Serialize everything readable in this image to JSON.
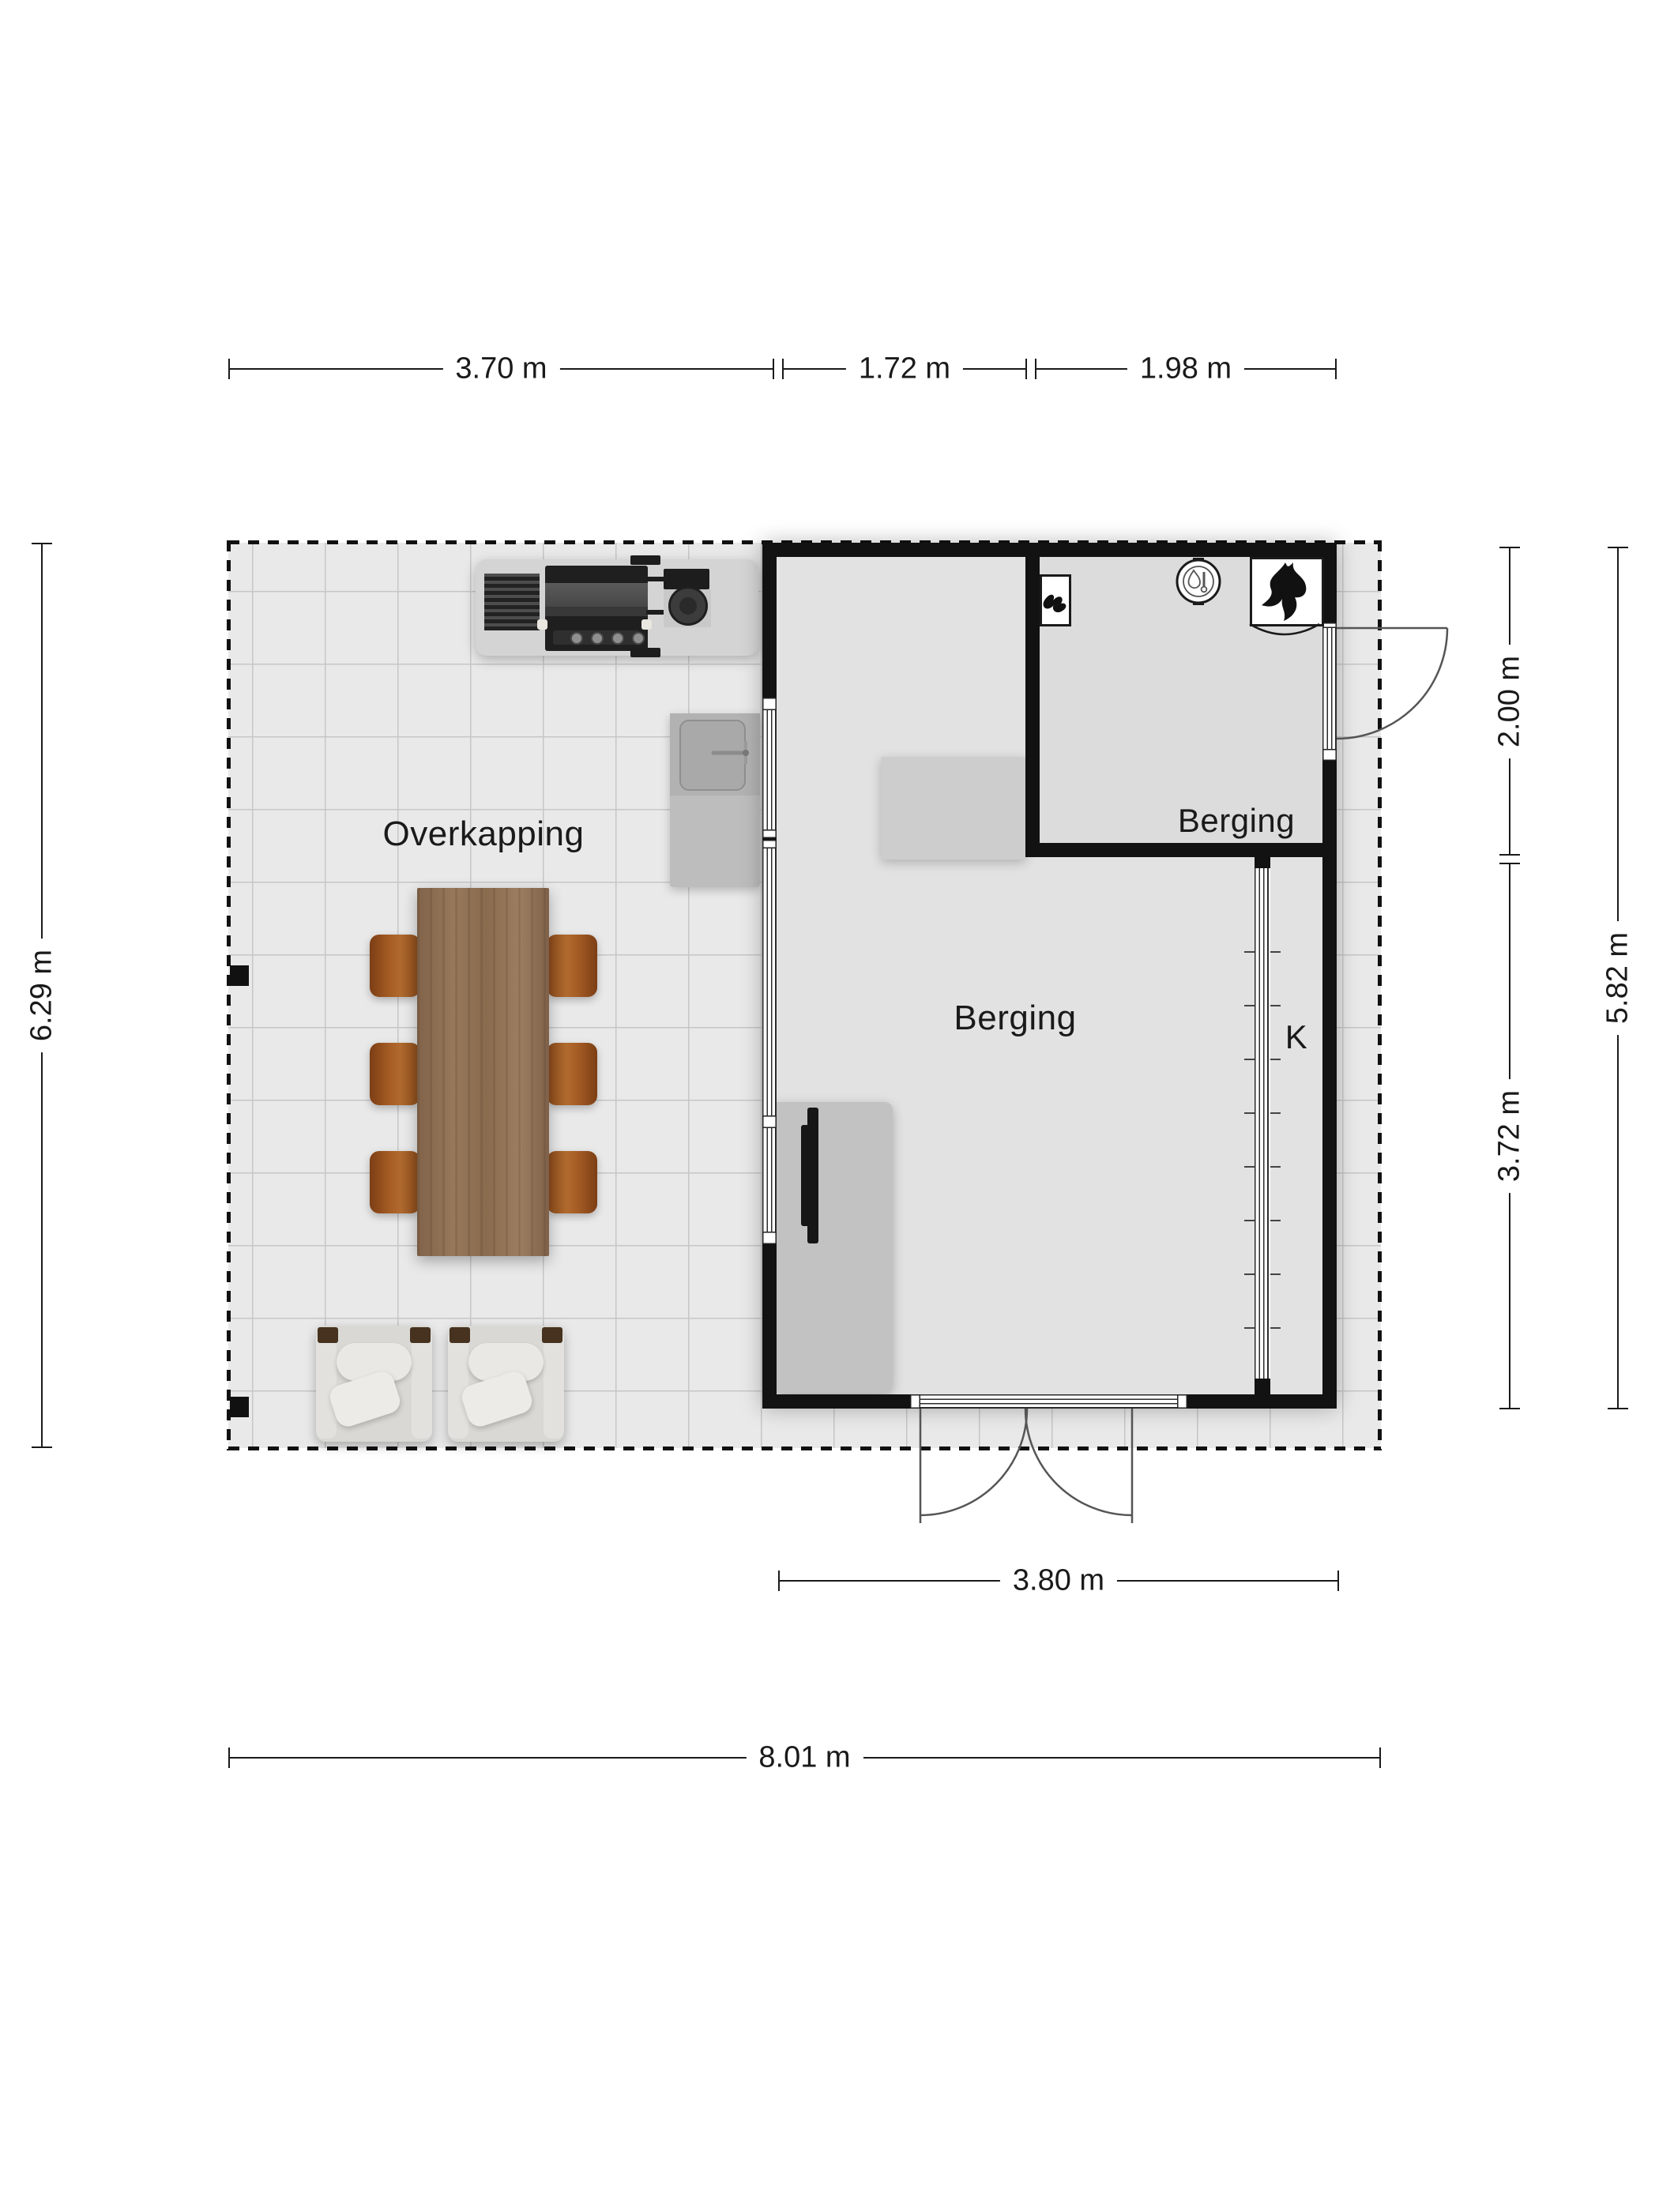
{
  "plan": {
    "type": "floor-plan"
  },
  "rooms": {
    "overkapping": {
      "label": "Overkapping"
    },
    "berging_main": {
      "label": "Berging"
    },
    "berging_top": {
      "label": "Berging"
    },
    "closet": {
      "label": "K"
    }
  },
  "dimensions": {
    "top": [
      {
        "label": "3.70 m"
      },
      {
        "label": "1.72 m"
      },
      {
        "label": "1.98 m"
      }
    ],
    "left": {
      "label": "6.29 m"
    },
    "right": [
      {
        "label": "2.00 m"
      },
      {
        "label": "3.72 m"
      },
      {
        "label": "5.82 m"
      }
    ],
    "bottom": [
      {
        "label": "3.80 m"
      },
      {
        "label": "8.01 m"
      }
    ]
  },
  "symbols": {
    "boiler": "cv-boiler-icon",
    "heater": "heater-flame-icon",
    "tap": "water-tap-icon"
  },
  "furniture": [
    "bbq-grill",
    "outdoor-sink",
    "dining-table",
    "dining-chairs",
    "lounge-chairs",
    "storage-cabinet",
    "wall-tv",
    "ladder"
  ],
  "colors": {
    "wall": "#121212",
    "floor": "#e9e9e9",
    "grid": "#c6c6c6",
    "wood": "#8d6e50",
    "chair": "#a05a24",
    "text": "#1a1a1a"
  }
}
